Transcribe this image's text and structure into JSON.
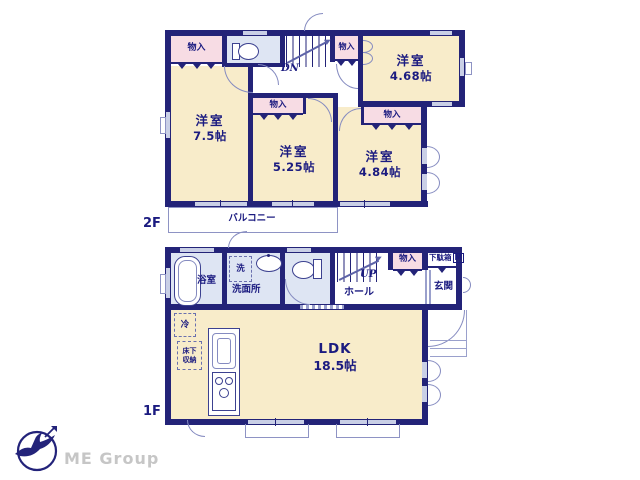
{
  "colors": {
    "wall_navy": "#232378",
    "room_cream": "#f8ecca",
    "closet_pink": "#f7dce4",
    "wet_area_blue": "#dee5f3",
    "text_navy": "#1b1b80",
    "logo_gray": "#c6c6c6"
  },
  "icons": {
    "logo_mark": "bird-in-circle-logo",
    "fixtures": [
      "toilet",
      "bathtub",
      "sink",
      "kitchen-sink",
      "stove",
      "stairs"
    ]
  },
  "f2": {
    "floor_label": "2F",
    "stairs_label": "DN",
    "balcony_label": "バルコニー",
    "closet_label": "物入",
    "rooms": [
      {
        "name": "洋室",
        "size": "4.68帖"
      },
      {
        "name": "洋室",
        "size": "7.5帖"
      },
      {
        "name": "洋室",
        "size": "5.25帖"
      },
      {
        "name": "洋室",
        "size": "4.84帖"
      }
    ]
  },
  "f1": {
    "floor_label": "1F",
    "stairs_label": "UP",
    "hall_label": "ホール",
    "bath_label": "浴室",
    "laundry_label": "洗",
    "washroom_label": "洗面所",
    "closet_label": "物入",
    "shoe_cabinet_label": "下駄箱",
    "shoe_cabinet_size": "M",
    "entrance_label": "玄関",
    "fridge_label": "冷",
    "underfloor_label_1": "床下",
    "underfloor_label_2": "収納",
    "ldk": {
      "name": "LDK",
      "size": "18.5帖"
    }
  },
  "logo": {
    "company": "ME Group"
  }
}
